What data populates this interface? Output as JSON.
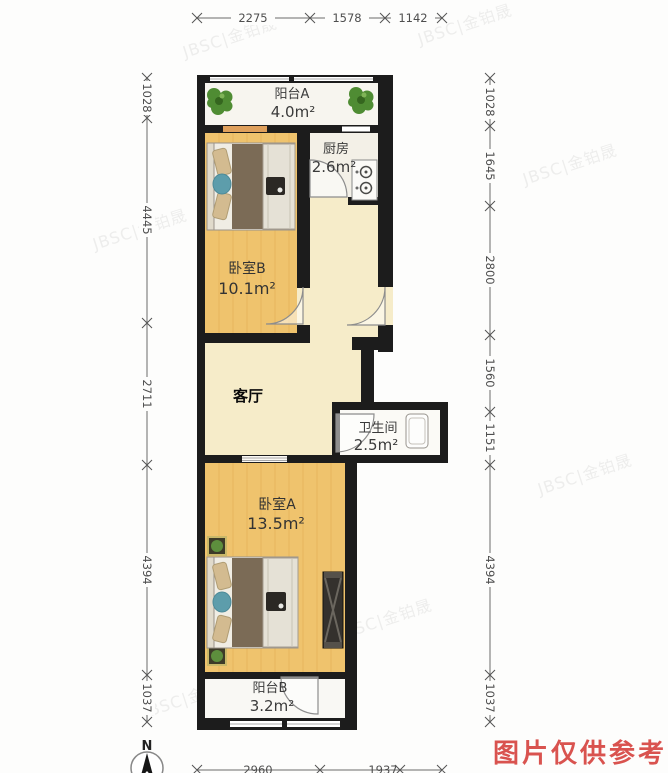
{
  "rooms": {
    "balcony_a": {
      "name": "阳台A",
      "area": "4.0m²"
    },
    "kitchen": {
      "name": "厨房",
      "area": "2.6m²"
    },
    "bedroom_b": {
      "name": "卧室B",
      "area": "10.1m²"
    },
    "living_room": {
      "name": "客厅"
    },
    "bathroom": {
      "name": "卫生间",
      "area": "2.5m²"
    },
    "bedroom_a": {
      "name": "卧室A",
      "area": "13.5m²"
    },
    "balcony_b": {
      "name": "阳台B",
      "area": "3.2m²"
    }
  },
  "dimensions": {
    "top": [
      "2275",
      "1578",
      "1142"
    ],
    "left": [
      "1028",
      "4445",
      "2711",
      "4394",
      "1037"
    ],
    "right": [
      "1028",
      "1645",
      "2800",
      "1560",
      "1151",
      "4394",
      "1037"
    ],
    "bottom": [
      "2960",
      "1937"
    ]
  },
  "compass": {
    "label": "N"
  },
  "watermark": {
    "text": "JBSC|金铂晟"
  },
  "notice": {
    "text": "图片仅供参考",
    "color": "#d9534f"
  },
  "colors": {
    "wall": "#1c1c1c",
    "wood_floor": "#efc36d",
    "cream_floor": "#f6ecc9",
    "balcony_floor": "#f7f5ef",
    "accent_red": "#d9534f"
  }
}
